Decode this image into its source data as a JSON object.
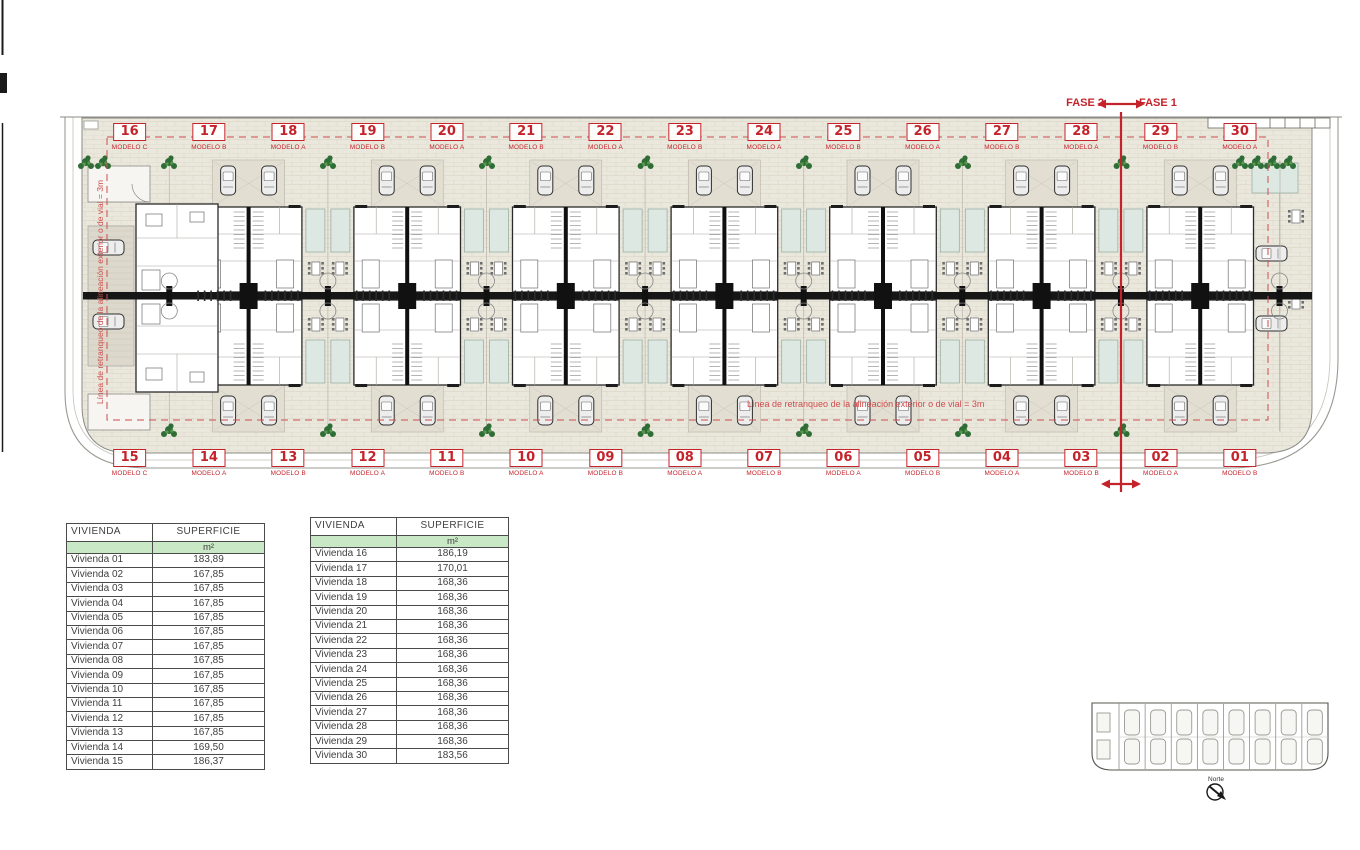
{
  "plan": {
    "phase_labels": {
      "left": "FASE 2",
      "right": "FASE 1"
    },
    "setback_text_horizontal": "Línea de retranqueo de la alineación exterior o de vial = 3m",
    "setback_text_vertical": "Línea de retranqueo de la alineación exterior o de vial = 3m",
    "top_units": [
      {
        "number": "16",
        "model": "MODELO C"
      },
      {
        "number": "17",
        "model": "MODELO B"
      },
      {
        "number": "18",
        "model": "MODELO A"
      },
      {
        "number": "19",
        "model": "MODELO B"
      },
      {
        "number": "20",
        "model": "MODELO A"
      },
      {
        "number": "21",
        "model": "MODELO B"
      },
      {
        "number": "22",
        "model": "MODELO A"
      },
      {
        "number": "23",
        "model": "MODELO B"
      },
      {
        "number": "24",
        "model": "MODELO A"
      },
      {
        "number": "25",
        "model": "MODELO B"
      },
      {
        "number": "26",
        "model": "MODELO A"
      },
      {
        "number": "27",
        "model": "MODELO B"
      },
      {
        "number": "28",
        "model": "MODELO A"
      },
      {
        "number": "29",
        "model": "MODELO B"
      },
      {
        "number": "30",
        "model": "MODELO A"
      }
    ],
    "bottom_units": [
      {
        "number": "15",
        "model": "MODELO C"
      },
      {
        "number": "14",
        "model": "MODELO A"
      },
      {
        "number": "13",
        "model": "MODELO B"
      },
      {
        "number": "12",
        "model": "MODELO A"
      },
      {
        "number": "11",
        "model": "MODELO B"
      },
      {
        "number": "10",
        "model": "MODELO A"
      },
      {
        "number": "09",
        "model": "MODELO B"
      },
      {
        "number": "08",
        "model": "MODELO A"
      },
      {
        "number": "07",
        "model": "MODELO B"
      },
      {
        "number": "06",
        "model": "MODELO A"
      },
      {
        "number": "05",
        "model": "MODELO B"
      },
      {
        "number": "04",
        "model": "MODELO A"
      },
      {
        "number": "03",
        "model": "MODELO B"
      },
      {
        "number": "02",
        "model": "MODELO A"
      },
      {
        "number": "01",
        "model": "MODELO B"
      }
    ],
    "colors": {
      "accent_red": "#c5232b",
      "dashed_red": "#cf4d4d",
      "site_beige": "#eae7dc",
      "pool_teal": "#dde8e2",
      "plant_green": "#2e6d35",
      "table_header_green": "#c9e8c6"
    }
  },
  "tables": [
    {
      "title_col": "VIVIENDA",
      "value_col": "SUPERFICIE",
      "unit_label": "m²",
      "rows": [
        [
          "Vivienda 01",
          "183,89"
        ],
        [
          "Vivienda 02",
          "167,85"
        ],
        [
          "Vivienda 03",
          "167,85"
        ],
        [
          "Vivienda 04",
          "167,85"
        ],
        [
          "Vivienda 05",
          "167,85"
        ],
        [
          "Vivienda 06",
          "167,85"
        ],
        [
          "Vivienda 07",
          "167,85"
        ],
        [
          "Vivienda 08",
          "167,85"
        ],
        [
          "Vivienda 09",
          "167,85"
        ],
        [
          "Vivienda 10",
          "167,85"
        ],
        [
          "Vivienda 11",
          "167,85"
        ],
        [
          "Vivienda 12",
          "167,85"
        ],
        [
          "Vivienda 13",
          "167,85"
        ],
        [
          "Vivienda 14",
          "169,50"
        ],
        [
          "Vivienda 15",
          "186,37"
        ]
      ]
    },
    {
      "title_col": "VIVIENDA",
      "value_col": "SUPERFICIE",
      "unit_label": "m²",
      "rows": [
        [
          "Vivienda 16",
          "186,19"
        ],
        [
          "Vivienda 17",
          "170,01"
        ],
        [
          "Vivienda 18",
          "168,36"
        ],
        [
          "Vivienda 19",
          "168,36"
        ],
        [
          "Vivienda 20",
          "168,36"
        ],
        [
          "Vivienda 21",
          "168,36"
        ],
        [
          "Vivienda 22",
          "168,36"
        ],
        [
          "Vivienda 23",
          "168,36"
        ],
        [
          "Vivienda 24",
          "168,36"
        ],
        [
          "Vivienda 25",
          "168,36"
        ],
        [
          "Vivienda 26",
          "168,36"
        ],
        [
          "Vivienda 27",
          "168,36"
        ],
        [
          "Vivienda 28",
          "168,36"
        ],
        [
          "Vivienda 29",
          "168,36"
        ],
        [
          "Vivienda 30",
          "183,56"
        ]
      ]
    }
  ],
  "key_plan": {
    "compass_label": "Norte"
  }
}
